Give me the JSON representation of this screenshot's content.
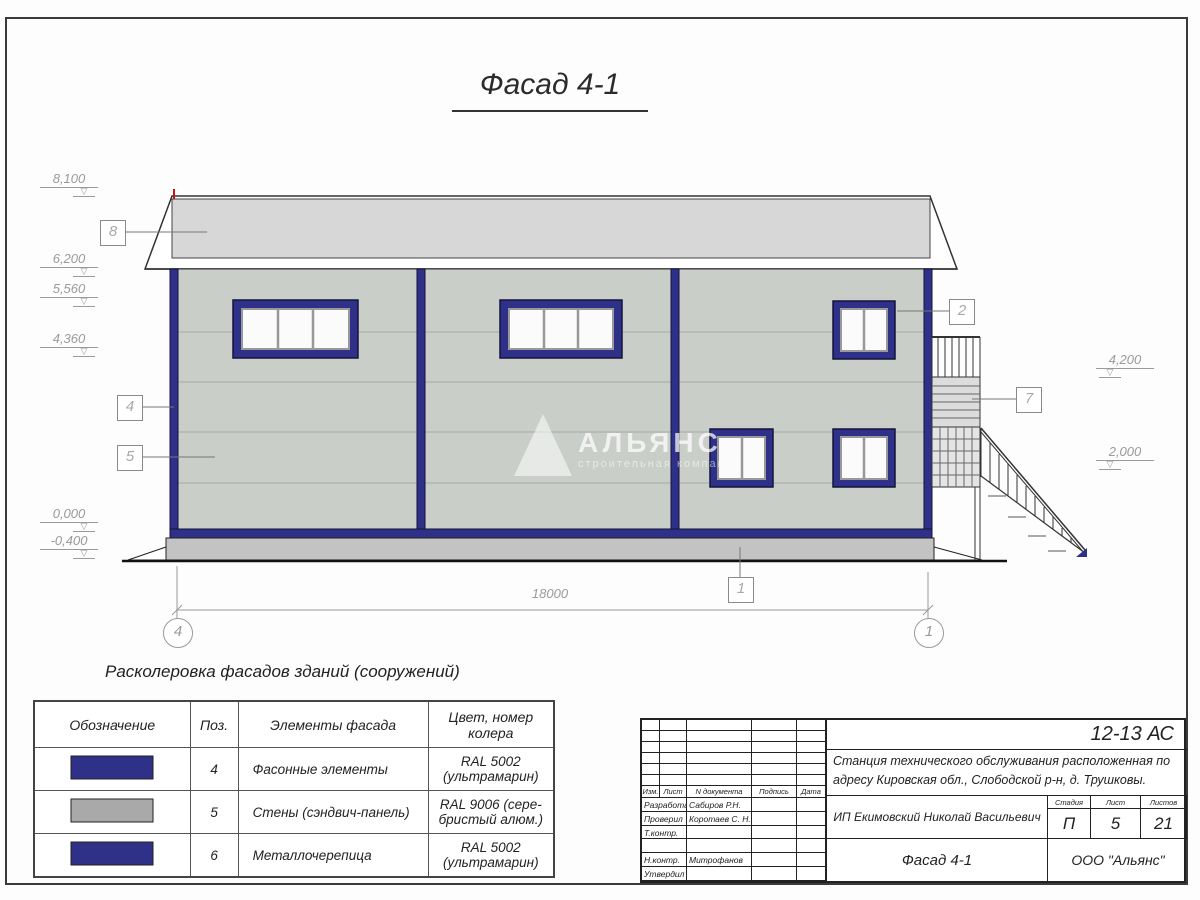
{
  "title": "Фасад 4-1",
  "elevations": {
    "left": [
      "8,100",
      "6,200",
      "5,560",
      "4,360",
      "0,000",
      "-0,400"
    ],
    "right": [
      "4,200",
      "2,000"
    ]
  },
  "callouts": {
    "roof": "8",
    "corner": "4",
    "wall": "5",
    "window": "2",
    "stair_landing": "7",
    "plinth": "1"
  },
  "axes": {
    "left": "4",
    "right": "1"
  },
  "dimensions": {
    "overall_length": "18000"
  },
  "watermark": {
    "name": "АЛЬЯНС",
    "tagline": "строительная компания"
  },
  "legend": {
    "title": "Расколеровка фасадов зданий (сооружений)",
    "headers": {
      "designation": "Обозначение",
      "pos": "Поз.",
      "element": "Элементы фасада",
      "color": "Цвет, номер колера"
    },
    "rows": [
      {
        "swatch": "#2e3187",
        "pos": "4",
        "element": "Фасонные элементы",
        "color": "RAL 5002 (ультрамарин)"
      },
      {
        "swatch": "#a9a9a9",
        "pos": "5",
        "element": "Стены (сэндвич-панель)",
        "color": "RAL 9006 (сере- бристый алюм.)"
      },
      {
        "swatch": "#2e3187",
        "pos": "6",
        "element": "Металлочерепица",
        "color": "RAL 5002 (ультрамарин)"
      }
    ]
  },
  "titleblock": {
    "doc_code": "12-13 АС",
    "project": "Станция технического обслуживания расположенная по адресу Кировская обл., Слободской р-н, д. Трушковы.",
    "change_header": {
      "izm": "Изм.",
      "list": "Лист",
      "doc": "N документа",
      "sign": "Подпись",
      "date": "Дата"
    },
    "roles": [
      {
        "role": "Разработал",
        "name": "Сабиров Р.Н."
      },
      {
        "role": "Проверил",
        "name": "Коротаев С. Н."
      },
      {
        "role": "Т.контр.",
        "name": ""
      },
      {
        "role": "",
        "name": ""
      },
      {
        "role": "Н.контр.",
        "name": "Митрофанов Я. А."
      },
      {
        "role": "Утвердил",
        "name": ""
      }
    ],
    "client": "ИП Екимовский Николай Васильевич",
    "stage_label": "Стадия",
    "sheet_label": "Лист",
    "sheets_label": "Листов",
    "stage": "П",
    "sheet": "5",
    "sheets": "21",
    "drawing_title": "Фасад 4-1",
    "company": "ООО \"Альянс\""
  },
  "colors": {
    "accent_blue": "#2e3187",
    "wall": "#c9cec8",
    "roof": "#d7d7d7",
    "plinth": "#c3c3c3"
  }
}
